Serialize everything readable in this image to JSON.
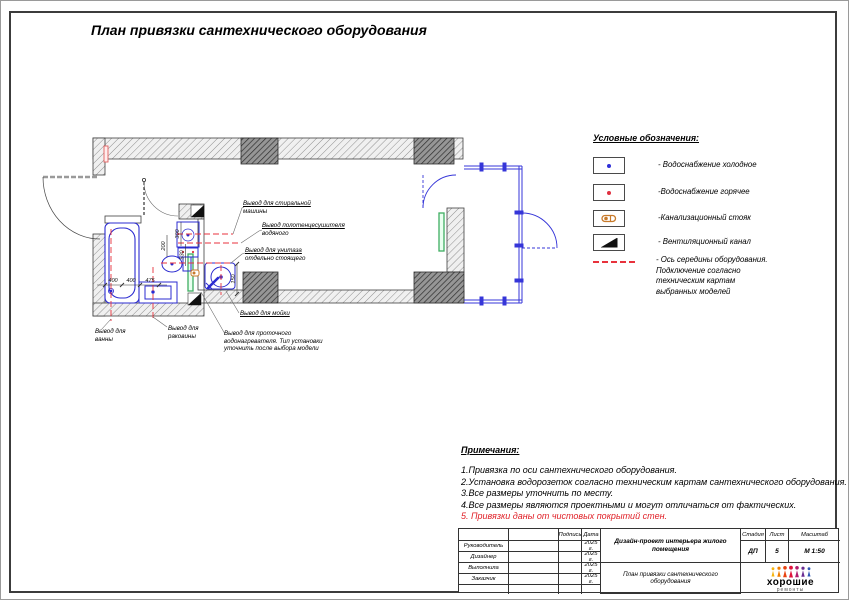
{
  "sheet": {
    "title": "План привязки сантехнического оборудования"
  },
  "plan": {
    "callouts": [
      {
        "lines": [
          "Вывод для стиральной",
          "машины"
        ]
      },
      {
        "lines": [
          "Вывод полотенцесушителя",
          "водяного"
        ]
      },
      {
        "lines": [
          "Вывод для унитаза",
          "отдельно стоящего"
        ]
      },
      {
        "lines": [
          "Вывод для мойки"
        ]
      },
      {
        "lines": [
          "Вывод для проточного",
          "водонагревателя. Тип установки",
          "уточнить после выбора модели"
        ]
      },
      {
        "lines": [
          "Вывод для",
          "ванны"
        ]
      },
      {
        "lines": [
          "Вывод для",
          "раковины"
        ]
      }
    ],
    "dims": {
      "bath_left": "400",
      "bath_right": "400",
      "basin": "475",
      "washer": "300",
      "towel": "200",
      "toilet": "530",
      "sink": "150"
    }
  },
  "legend": {
    "heading": "Условные обозначения:",
    "items": [
      {
        "name": "cold-water-symbol",
        "label": "- Водоснабжение холодное"
      },
      {
        "name": "hot-water-symbol",
        "label": "-Водоснабжение горячее"
      },
      {
        "name": "sewer-riser-symbol",
        "label": "-Канализационный стояк"
      },
      {
        "name": "vent-channel-symbol",
        "label": "- Вентиляционный канал"
      },
      {
        "name": "equipment-axis-symbol",
        "label": "- Ось середины оборудования.\n Подключение согласно\n техническим картам\n выбранных моделей"
      }
    ]
  },
  "notes": {
    "heading": "Примечания:",
    "items": [
      "1.Привязка по оси сантехнического оборудования.",
      "2.Установка водорозеток согласно техническим картам сантехнического оборудования.",
      "3.Все размеры уточнить по месту.",
      "4.Все размеры являются проектными и могут отличаться от фактических.",
      "5. Привязки даны от чистовых покрытий стен."
    ]
  },
  "titleblock": {
    "signature_header": "Подпись",
    "date_header": "Дата",
    "roles": [
      "Руководитель",
      "Дизайнер",
      "Выполнила",
      "Заказчик"
    ],
    "dates": [
      "2025 г.",
      "2025 г.",
      "2025 г.",
      "2025 г."
    ],
    "project": "Дизайн-проект интерьера жилого помещения",
    "drawing_title": "План привязки сантехнического оборудования",
    "stage_header": "Стадия",
    "stage_value": "ДП",
    "sheet_header": "Лист",
    "sheet_value": "5",
    "scale_header": "Масштаб",
    "scale_value": "М 1:50",
    "logo_title": "хорошие",
    "logo_subtitle": "ремонты"
  },
  "colors": {
    "axis_red": "#e8323c",
    "fixture_blue": "#2b2bd0",
    "vent_green": "#3fae62",
    "sewer_orange": "#c87a2a"
  }
}
